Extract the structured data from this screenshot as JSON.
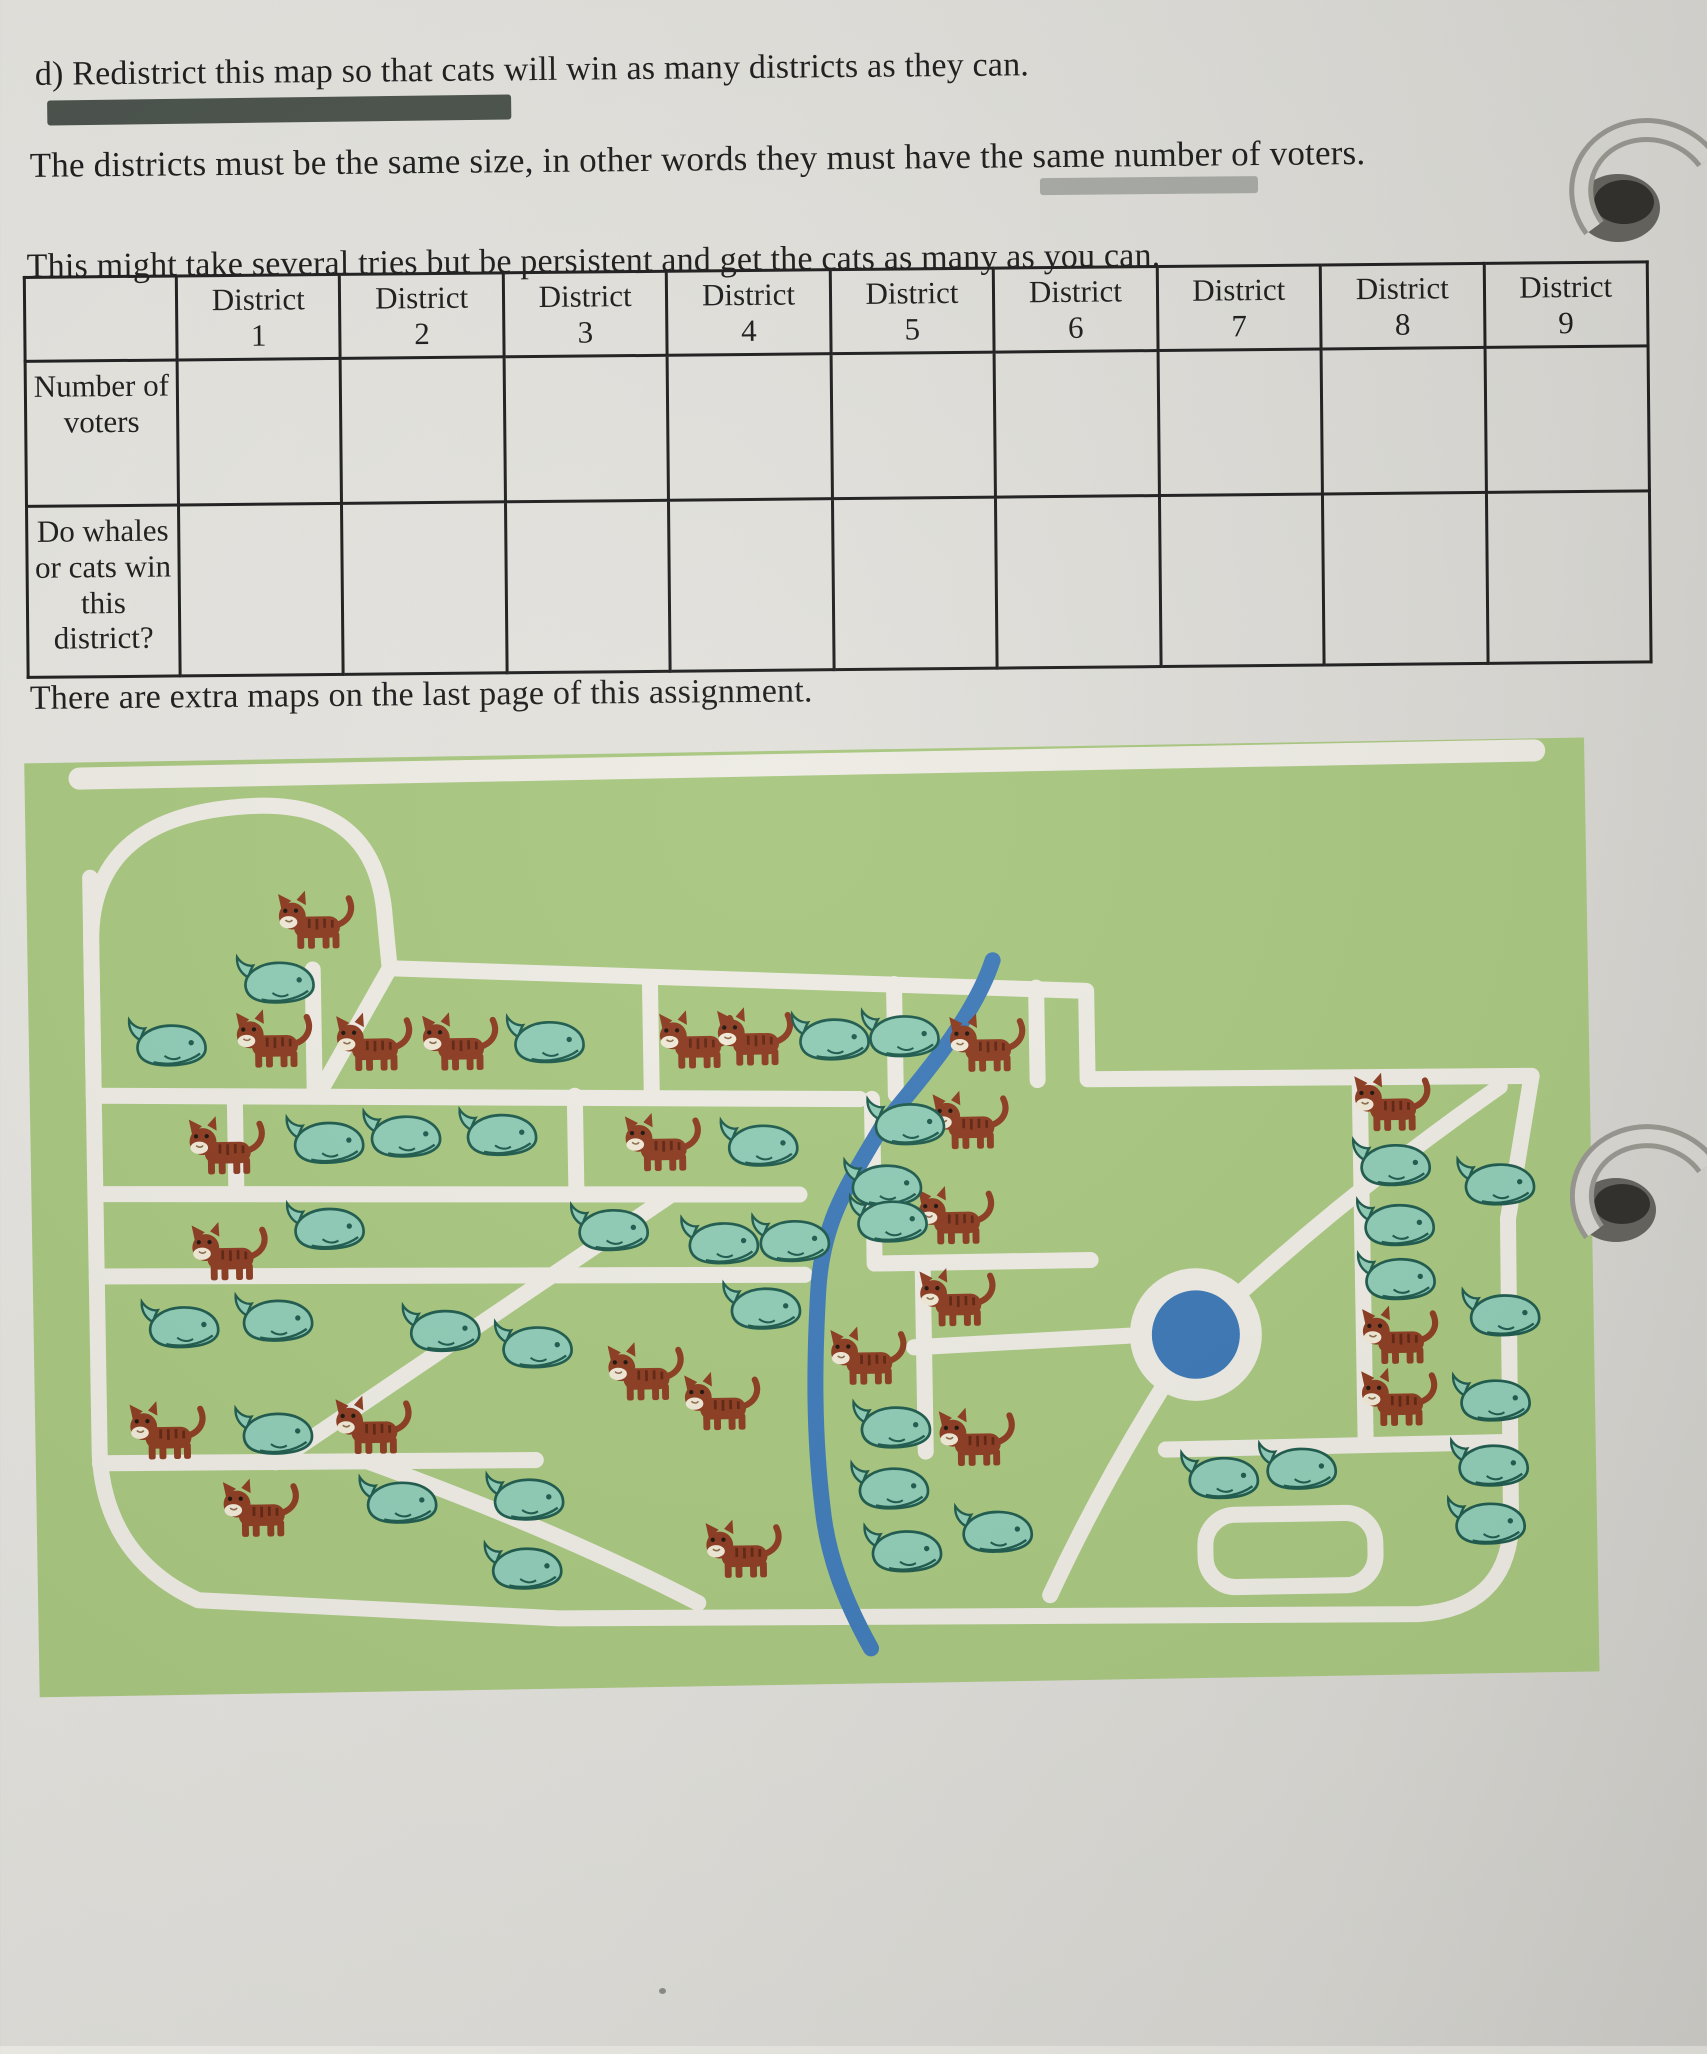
{
  "page": {
    "lines": {
      "instruction": "d) Redistrict this map so that cats will win as many districts as they can.",
      "size_rule": "The districts must be the same size, in other words they must have the same number of voters.",
      "persistence": "This might take several tries but be persistent and get the cats as many as you can.",
      "extra_maps": "There are extra maps on the last page of this assignment."
    }
  },
  "table": {
    "corner": "",
    "columns": [
      {
        "name": "District",
        "number": "1"
      },
      {
        "name": "District",
        "number": "2"
      },
      {
        "name": "District",
        "number": "3"
      },
      {
        "name": "District",
        "number": "4"
      },
      {
        "name": "District",
        "number": "5"
      },
      {
        "name": "District",
        "number": "6"
      },
      {
        "name": "District",
        "number": "7"
      },
      {
        "name": "District",
        "number": "8"
      },
      {
        "name": "District",
        "number": "9"
      }
    ],
    "rows": [
      {
        "label": "Number of voters"
      },
      {
        "label": "Do whales or cats win this district?"
      }
    ]
  },
  "map": {
    "counts": {
      "cats": 24,
      "whales": 39,
      "total_voters": 63
    },
    "colors": {
      "grass": "#a7c67e",
      "road": "#edebe3",
      "river": "#3d79b7",
      "pond": "#3a76b4",
      "cat": "#8b3a1f",
      "catstripe": "#5e2410",
      "whale": "#8ecbb5",
      "whaleline": "#1d5a4c",
      "paper": "#e1e0db",
      "ink": "#1b1b1b"
    },
    "cats": [
      [
        18.6,
        17.6
      ],
      [
        15.8,
        30.2
      ],
      [
        22.2,
        30.7
      ],
      [
        27.7,
        30.8
      ],
      [
        42.9,
        31.0
      ],
      [
        46.6,
        30.8
      ],
      [
        61.5,
        31.9
      ],
      [
        12.6,
        41.5
      ],
      [
        40.6,
        42.0
      ],
      [
        60.3,
        40.1
      ],
      [
        59.3,
        50.3
      ],
      [
        12.7,
        52.9
      ],
      [
        59.3,
        59.1
      ],
      [
        53.5,
        65.2
      ],
      [
        39.2,
        66.5
      ],
      [
        44.1,
        69.8
      ],
      [
        8.5,
        72.0
      ],
      [
        21.7,
        71.7
      ],
      [
        60.4,
        74.1
      ],
      [
        14.4,
        80.4
      ],
      [
        45.3,
        85.6
      ],
      [
        87.4,
        39.0
      ],
      [
        87.6,
        63.9
      ],
      [
        87.5,
        70.6
      ]
    ],
    "whales": [
      [
        15.8,
        23.7
      ],
      [
        8.8,
        30.2
      ],
      [
        33.0,
        30.5
      ],
      [
        51.3,
        30.7
      ],
      [
        55.8,
        30.5
      ],
      [
        18.8,
        40.9
      ],
      [
        23.7,
        40.4
      ],
      [
        29.9,
        40.4
      ],
      [
        56.0,
        39.9
      ],
      [
        46.6,
        42.0
      ],
      [
        54.5,
        46.5
      ],
      [
        54.8,
        50.3
      ],
      [
        18.7,
        50.1
      ],
      [
        36.9,
        50.8
      ],
      [
        44.0,
        52.4
      ],
      [
        48.5,
        52.2
      ],
      [
        9.3,
        60.4
      ],
      [
        15.3,
        59.9
      ],
      [
        26.0,
        61.2
      ],
      [
        31.9,
        63.2
      ],
      [
        46.6,
        59.4
      ],
      [
        15.2,
        71.9
      ],
      [
        54.8,
        72.4
      ],
      [
        54.6,
        78.9
      ],
      [
        23.1,
        79.5
      ],
      [
        31.2,
        79.4
      ],
      [
        31.0,
        86.8
      ],
      [
        55.4,
        85.6
      ],
      [
        61.2,
        83.7
      ],
      [
        87.1,
        45.2
      ],
      [
        93.8,
        47.4
      ],
      [
        87.3,
        51.6
      ],
      [
        87.3,
        57.4
      ],
      [
        94.0,
        61.5
      ],
      [
        93.3,
        70.6
      ],
      [
        75.8,
        78.4
      ],
      [
        80.8,
        77.5
      ],
      [
        93.1,
        77.5
      ],
      [
        92.8,
        83.7
      ]
    ]
  }
}
